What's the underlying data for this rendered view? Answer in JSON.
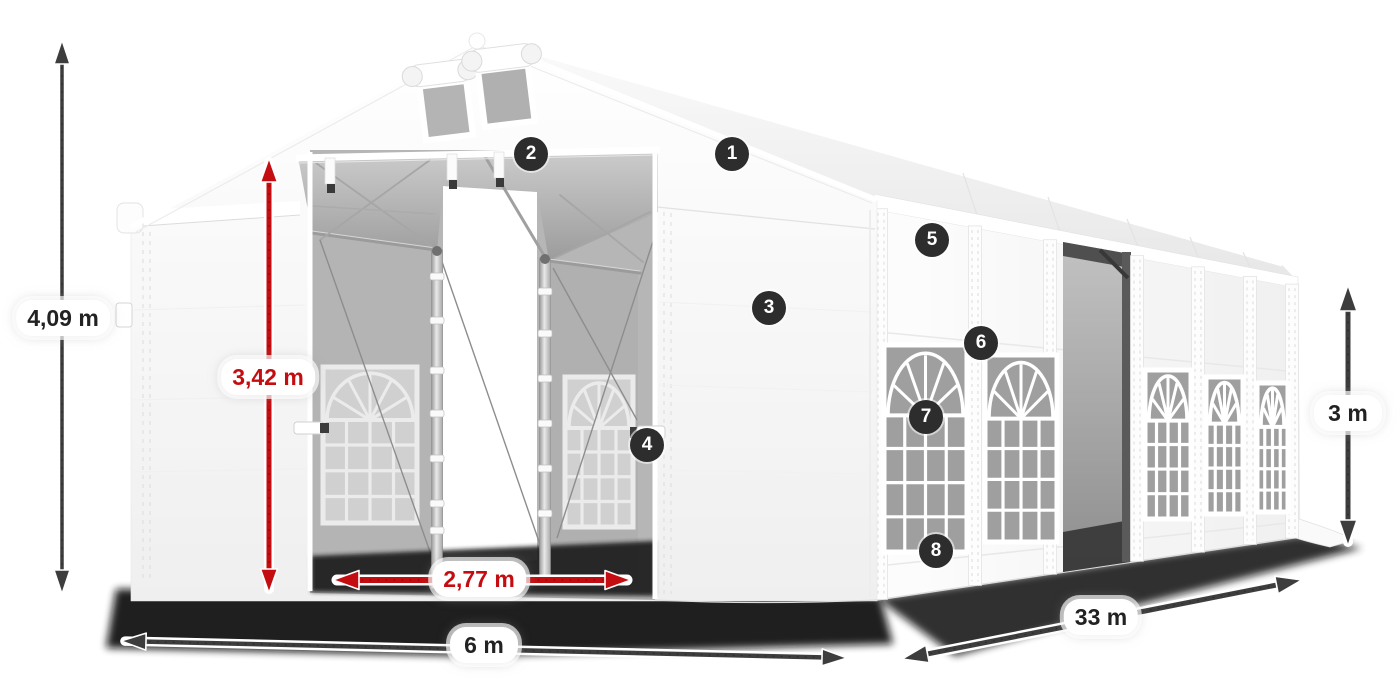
{
  "diagram": {
    "dimensions": {
      "total_height": {
        "label": "4,09 m",
        "color": "black"
      },
      "entrance_height": {
        "label": "3,42 m",
        "color": "red"
      },
      "entrance_width": {
        "label": "2,77 m",
        "color": "red"
      },
      "width": {
        "label": "6 m",
        "color": "black"
      },
      "length": {
        "label": "33 m",
        "color": "black"
      },
      "side_height": {
        "label": "3 m",
        "color": "black"
      }
    },
    "callouts": [
      "1",
      "2",
      "3",
      "4",
      "5",
      "6",
      "7",
      "8"
    ],
    "colors": {
      "accent_red": "#c40d10",
      "arrow_dark": "#3d3d3d",
      "badge_bg": "#2d2d2d",
      "tent_white": "#fafafa",
      "interior_gray": "#b4b4b4"
    }
  }
}
